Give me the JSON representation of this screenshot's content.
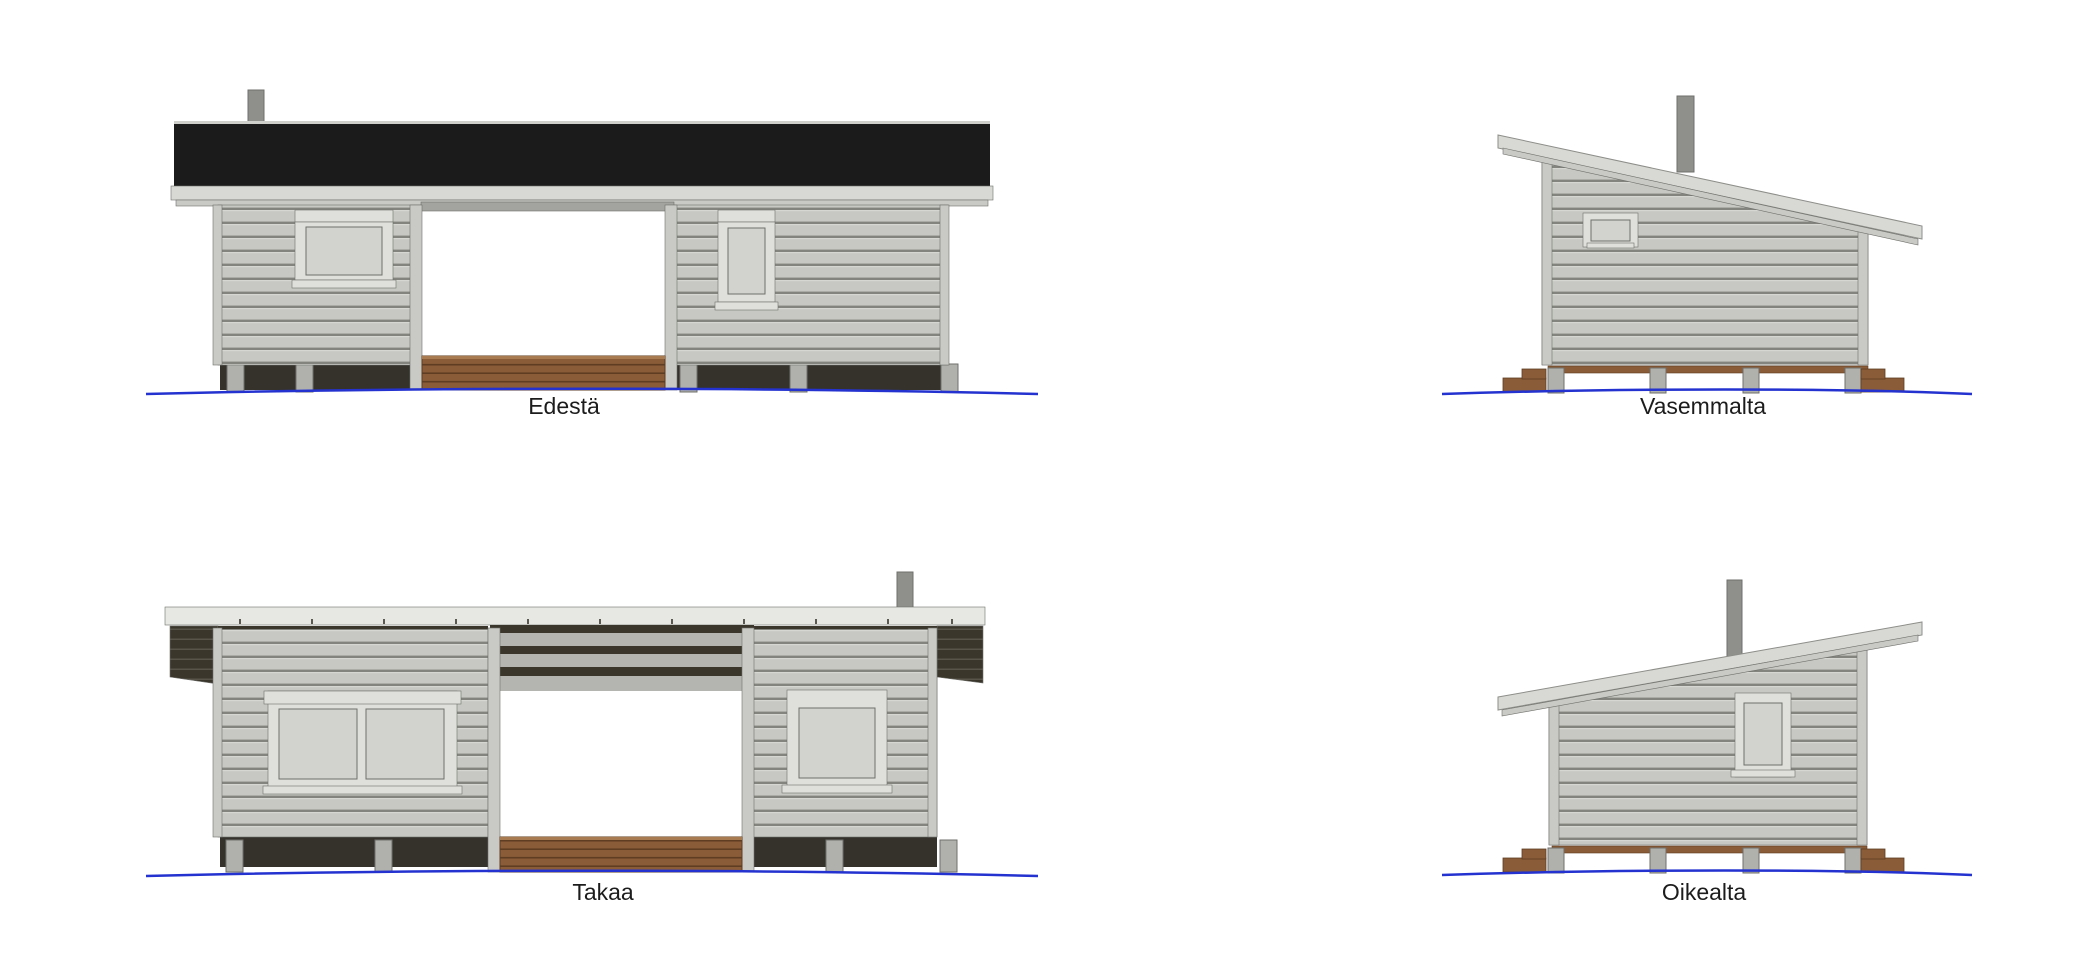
{
  "sheet": {
    "type": "architectural-elevations",
    "building": "cabin-with-open-porch"
  },
  "views": {
    "front": {
      "label": "Edestä"
    },
    "left_side": {
      "label": "Vasemmalta"
    },
    "back": {
      "label": "Takaa"
    },
    "right_side": {
      "label": "Oikealta"
    }
  },
  "colors": {
    "page_bg": "#ffffff",
    "roof_black": "#1b1b1b",
    "roof_black_hi": "#cfcfcb",
    "fascia": "#d8d9d5",
    "fascia_edge": "#8d8e8a",
    "fascia_white": "#e7e8e4",
    "siding": "#c7c8c3",
    "siding_gap": "#83847e",
    "siding_hi": "#d6d7d3",
    "trim": "#c9cac6",
    "window_trim": "#dfe0dc",
    "glass": "#d2d3cf",
    "outline": "#6f706c",
    "header_gray": "#a3a4a0",
    "beam_gray": "#b4b5b1",
    "dark_wood": "#3a362c",
    "dark_wood_line": "#59544a",
    "foundation": "#35322c",
    "deck": "#8a5c38",
    "deck_line": "#5e3d22",
    "deck_hi": "#a87c50",
    "pier": "#b0b1ad",
    "chimney": "#8f908b",
    "ground_blue": "#2433cf",
    "label": "#1c1c1c"
  }
}
